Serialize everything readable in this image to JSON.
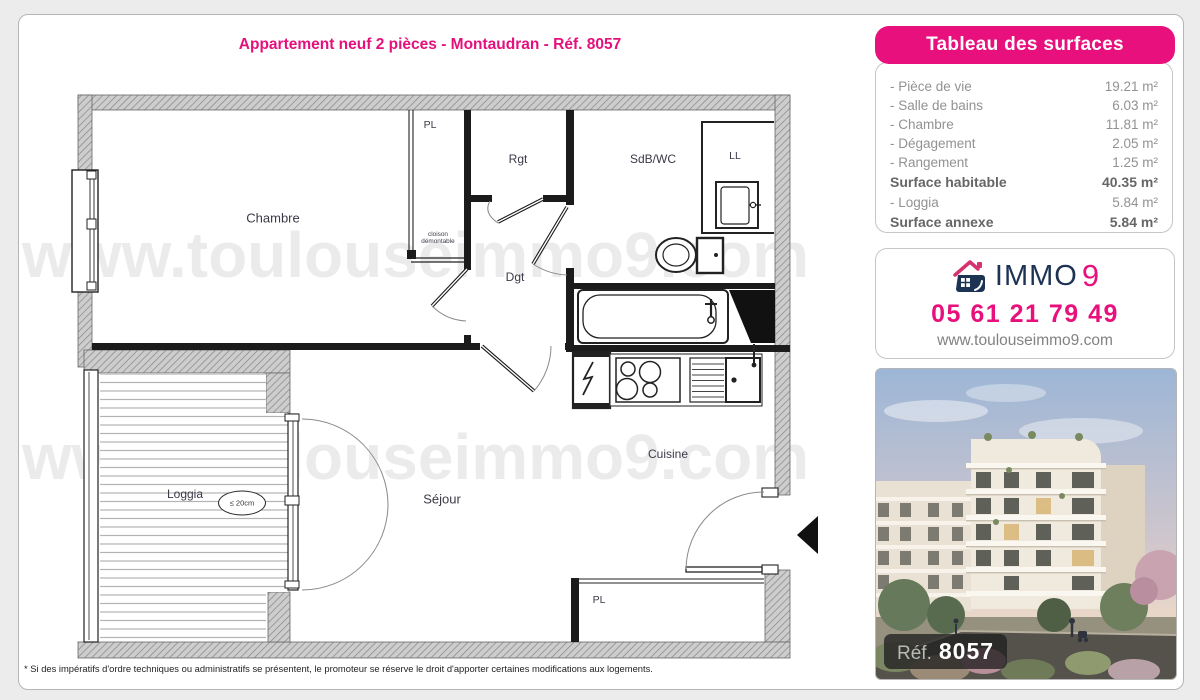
{
  "title": "Appartement neuf 2 pièces - Montaudran - Réf. 8057",
  "watermark": "www.toulouseimmo9.com",
  "disclaimer": "* Si des impératifs d'ordre techniques ou administratifs se présentent, le promoteur se réserve le droit d'apporter certaines modifications aux logements.",
  "surfaces_panel": {
    "header": "Tableau des surfaces",
    "rows": [
      {
        "label": "- Pièce de vie",
        "value": "19.21 m²",
        "bold": false
      },
      {
        "label": "- Salle de bains",
        "value": "6.03 m²",
        "bold": false
      },
      {
        "label": "- Chambre",
        "value": "11.81 m²",
        "bold": false
      },
      {
        "label": "- Dégagement",
        "value": "2.05 m²",
        "bold": false
      },
      {
        "label": "- Rangement",
        "value": "1.25 m²",
        "bold": false
      },
      {
        "label": "Surface habitable",
        "value": "40.35 m²",
        "bold": true
      },
      {
        "label": "- Loggia",
        "value": "5.84 m²",
        "bold": false
      },
      {
        "label": "Surface annexe",
        "value": "5.84 m²",
        "bold": true
      }
    ]
  },
  "agency": {
    "brand_text": "IMMO",
    "brand_digit": "9",
    "phone": "05 61 21 79 49",
    "website": "www.toulouseimmo9.com"
  },
  "photo": {
    "ref_label": "Réf.",
    "ref_value": "8057"
  },
  "plan": {
    "labels": {
      "chambre": "Chambre",
      "pl_top": "PL",
      "rgt": "Rgt",
      "sdb": "SdB/WC",
      "ll": "LL",
      "dgt": "Dgt",
      "cloison_line1": "cloison",
      "cloison_line2": "démontable",
      "sejour": "Séjour",
      "cuisine": "Cuisine",
      "loggia": "Loggia",
      "pl_bottom": "PL",
      "threshold_note": "≤ 20cm"
    }
  },
  "colors": {
    "accent_pink": "#e8107c",
    "brand_navy": "#1d3353"
  }
}
